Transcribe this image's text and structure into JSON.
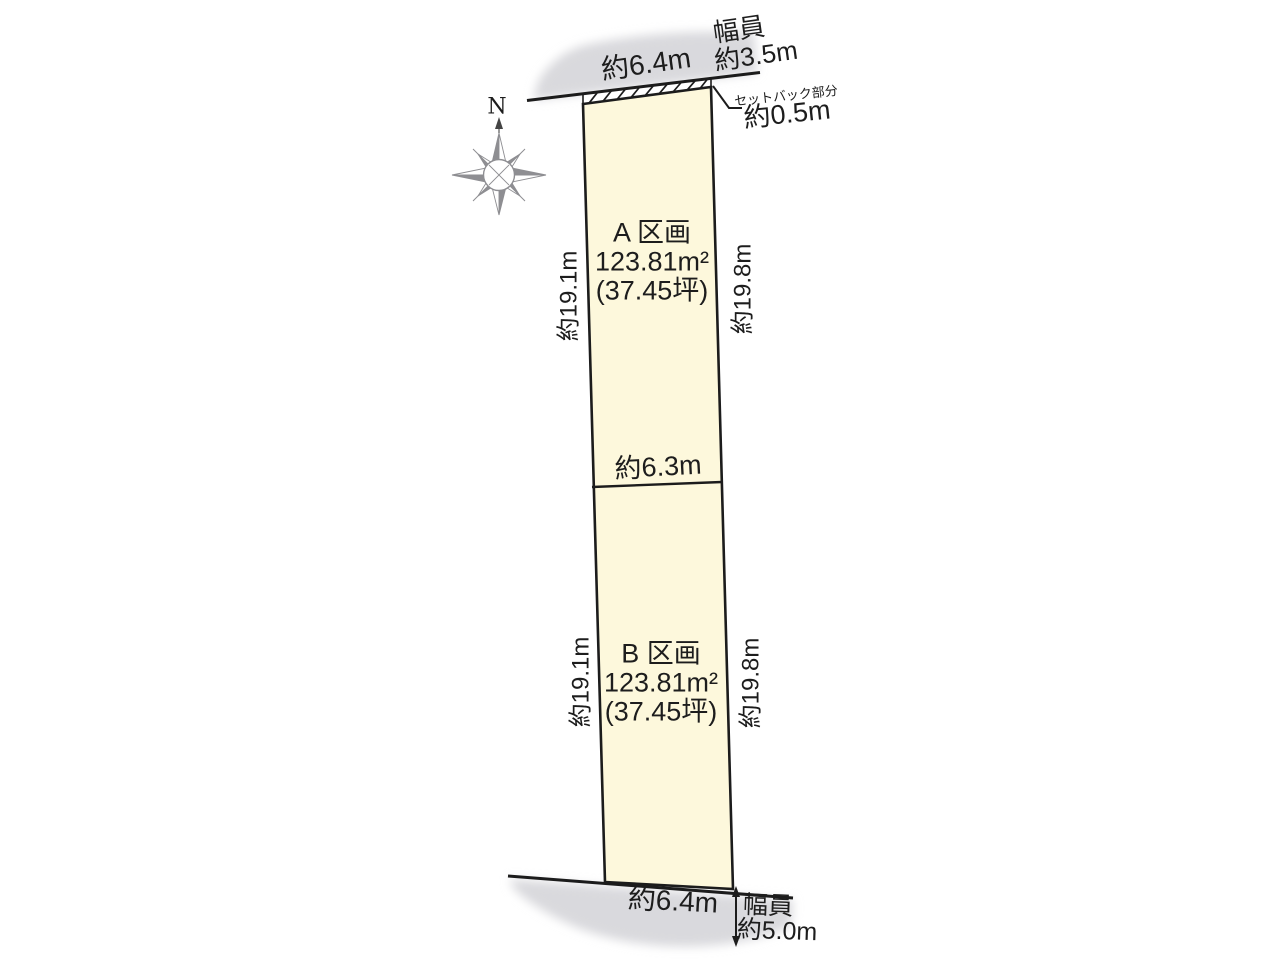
{
  "compass": {
    "north": "N"
  },
  "top_road": {
    "frontage": "約6.4m",
    "width_label": "幅員",
    "width_value": "約3.5m"
  },
  "setback": {
    "label": "セットバック部分",
    "value": "約0.5m"
  },
  "parcel_a": {
    "name": "A 区画",
    "area": "123.81m²",
    "tsubo": "(37.45坪)",
    "side_left": "約19.1m",
    "side_right": "約19.8m"
  },
  "divider": {
    "width": "約6.3m"
  },
  "parcel_b": {
    "name": "B 区画",
    "area": "123.81m²",
    "tsubo": "(37.45坪)",
    "side_left": "約19.1m",
    "side_right": "約19.8m"
  },
  "bottom_road": {
    "frontage": "約6.4m",
    "width_label": "幅員",
    "width_value": "約5.0m"
  },
  "colors": {
    "parcel_fill": "#fdf8dc",
    "road_gray": "#d9d9dd",
    "line": "#1c1c1c"
  }
}
